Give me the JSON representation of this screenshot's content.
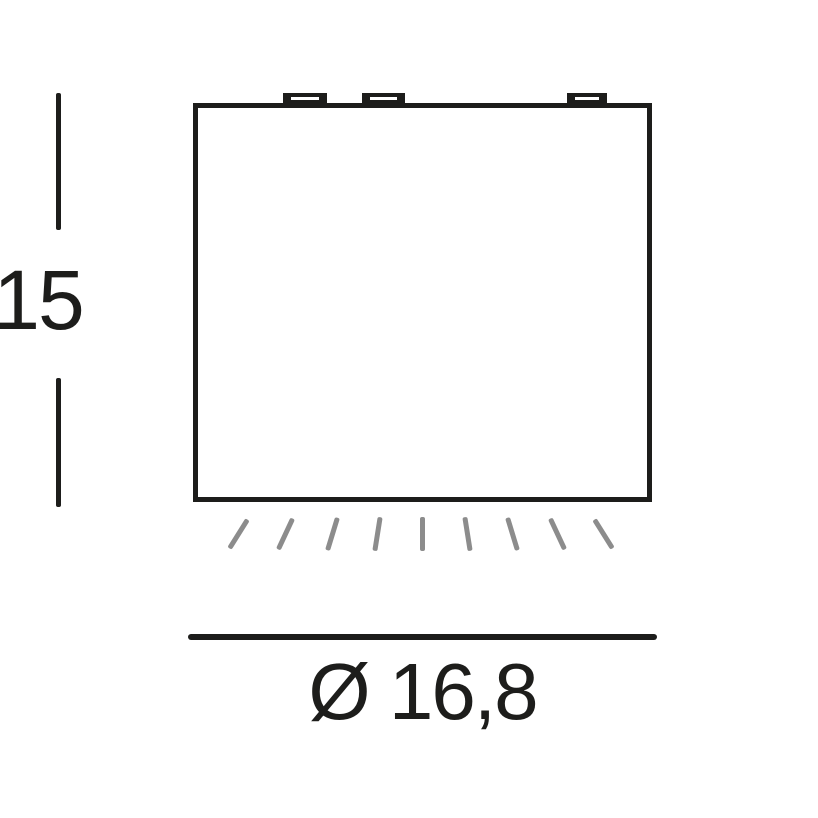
{
  "labels": {
    "height": "15",
    "diameter": "Ø 16,8"
  },
  "colors": {
    "line": "#1d1d1b",
    "ray": "#8c8c8c",
    "background": "#ffffff"
  },
  "counts": {
    "mounting_tabs": 3,
    "light_rays": 9
  }
}
